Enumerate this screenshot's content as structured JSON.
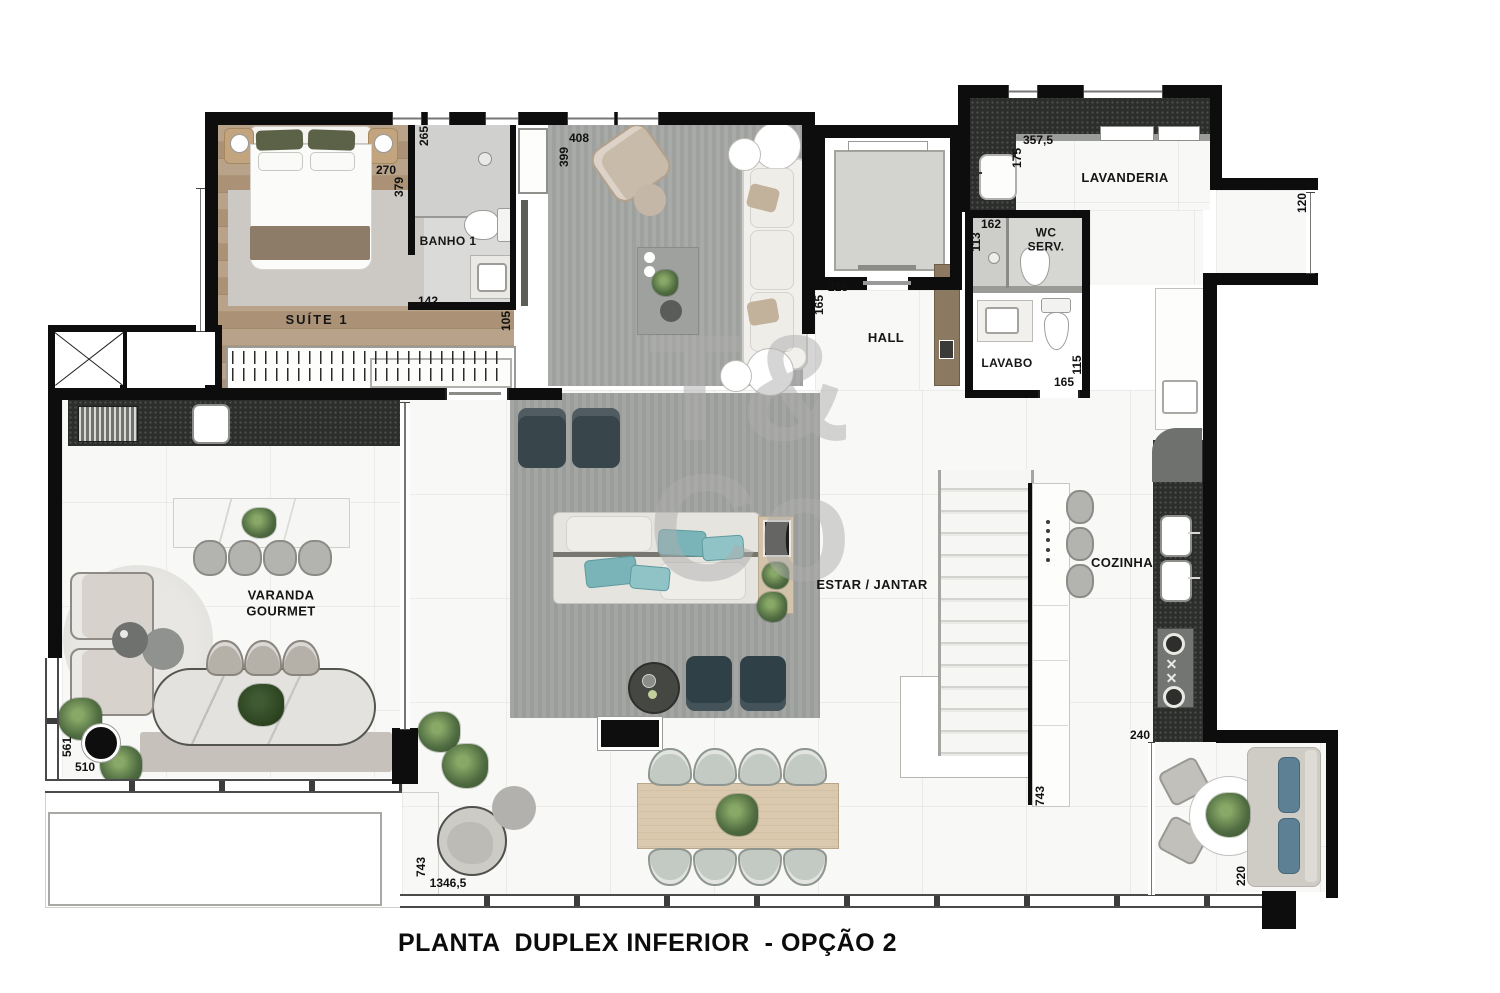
{
  "title": "PLANTA  DUPLEX INFERIOR  - OPÇÃO 2",
  "watermark": {
    "line1": "T&",
    "line2": "Co"
  },
  "rooms": {
    "suite1": "SUÍTE 1",
    "banho1": "BANHO 1",
    "hall": "HALL",
    "lavanderia": "LAVANDERIA",
    "wc_serv": "WC SERV.",
    "lavabo": "LAVABO",
    "estar_jantar": "ESTAR / JANTAR",
    "cozinha": "COZINHA",
    "varanda_gourmet": "VARANDA GOURMET"
  },
  "dimensions": {
    "d265": "265",
    "d270": "270",
    "d379": "379",
    "d142": "142",
    "d105": "105",
    "d399": "399",
    "d408": "408",
    "d215": "215",
    "d165_hall": "165",
    "d357_5": "357,5",
    "d175": "175",
    "d162": "162",
    "d113": "113",
    "d165_lavabo": "165",
    "d115": "115",
    "d120": "120",
    "d561": "561",
    "d510": "510",
    "d743_varanda": "743",
    "d1346_5": "1346,5",
    "d240": "240",
    "d743_stairs": "743",
    "d220": "220"
  }
}
